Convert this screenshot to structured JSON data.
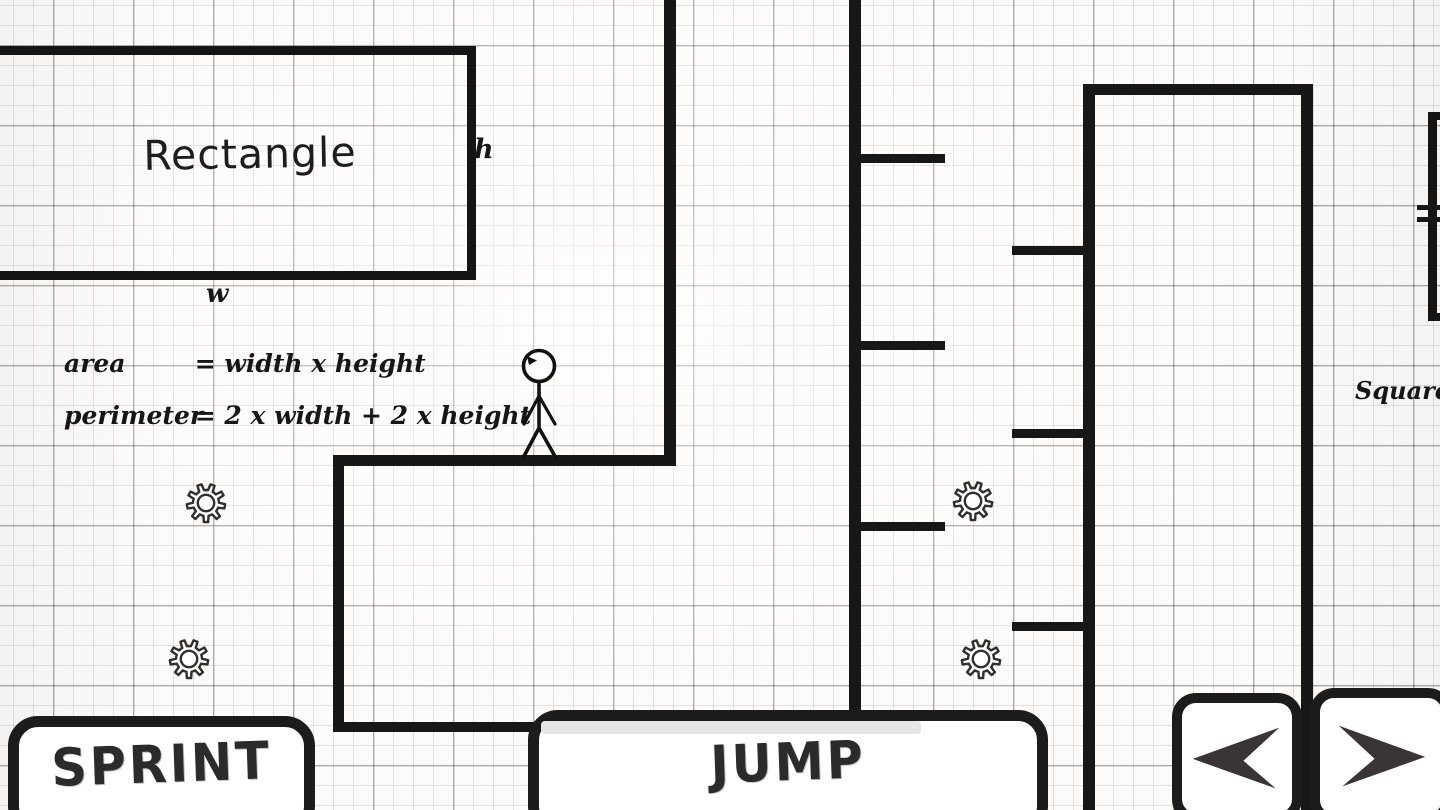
{
  "lesson": {
    "rectangle": {
      "title": "Rectangle",
      "height_label": "h",
      "width_label": "w",
      "formulas": [
        {
          "name": "area",
          "eq": "= width x height"
        },
        {
          "name": "perimeter",
          "eq": "= 2 x width + 2 x height"
        }
      ]
    },
    "square": {
      "title": "Square"
    }
  },
  "controls": {
    "sprint_label": "SPRINT",
    "jump_label": "JUMP",
    "nav_left_icon": "left-arrow-icon",
    "nav_right_icon": "right-arrow-icon"
  },
  "entities": {
    "player": "stick-figure",
    "collectible": "gear-icon",
    "gear_count": 4
  },
  "colors": {
    "paper": "#fcfbf9",
    "ink": "#171717",
    "button_border": "#1c1c1c",
    "arrow_glyph": "#3a3437",
    "jump_meter": "#e6e6e6"
  }
}
